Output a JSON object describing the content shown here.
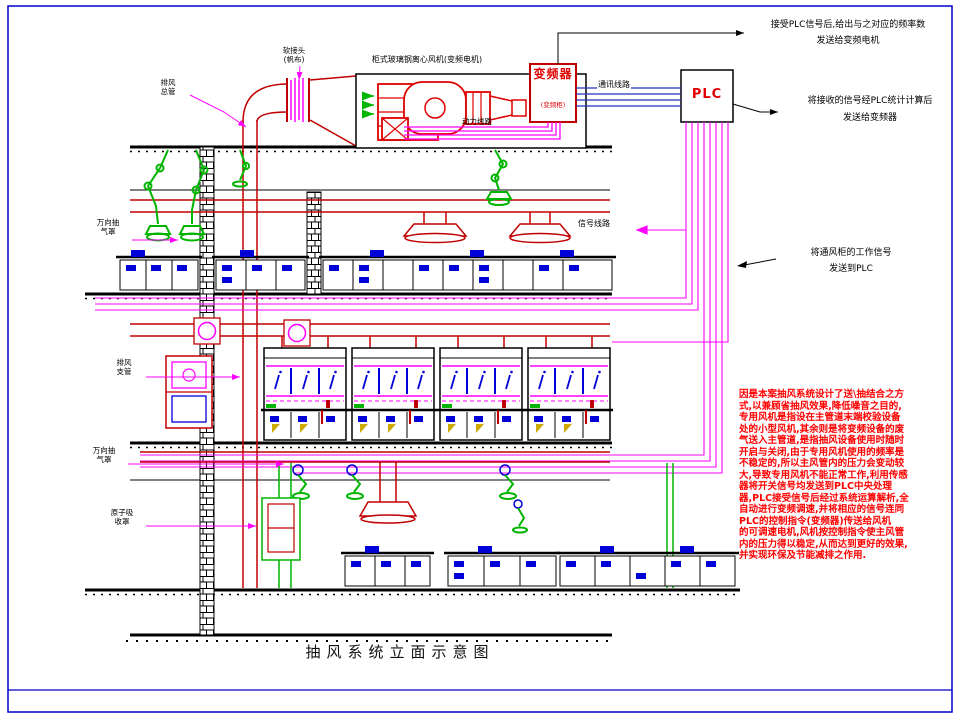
{
  "drawing": {
    "title": "抽风系统立面示意图",
    "colors": {
      "duct_red": "#c00000",
      "signal_magenta": "#ff00ff",
      "device_green": "#00b400",
      "bench_blue": "#0000d8",
      "comm_blue": "#2233bb",
      "note_red": "#ff0000",
      "border_blue": "#0000cc"
    },
    "equipment": {
      "fan_label": "柜式玻璃钢离心风机(变频电机)",
      "vfd_name": "变频器",
      "vfd_sub": "(变频柜)",
      "plc_name": "PLC"
    },
    "line_labels": {
      "comm": "通讯线路",
      "power": "动力线路",
      "signal": "信号线路"
    },
    "callouts": {
      "top_right": {
        "line1": "接受PLC信号后,给出与之对应的频率数",
        "line2": "发送给变频电机"
      },
      "plc_right": {
        "line1": "将接收的信号经PLC统计计算后",
        "line2": "发送给变频器"
      },
      "hood_signal": {
        "line1": "将通风柜的工作信号",
        "line2": "发送到PLC"
      },
      "left": [
        {
          "line1": "排风",
          "line2": "总管"
        },
        {
          "line1": "软接头",
          "line2": "(帆布)"
        },
        {
          "line1": "万向抽",
          "line2": "气罩"
        },
        {
          "line1": "排风",
          "line2": "支管"
        },
        {
          "line1": "万向抽",
          "line2": "气罩"
        },
        {
          "line1": "原子吸",
          "line2": "收罩"
        }
      ]
    },
    "description_lines": [
      "因是本案抽风系统设计了送\\抽结合之方",
      "式,以兼顾省抽风效果,降低噪音之目的,",
      "专用风机是指设在主管道末端校验设备",
      "处的小型风机,其余则是将变频设备的废",
      "气送入主管道,是指抽风设备使用时随时",
      "开启与关闭,由于专用风机使用的频率是",
      "不稳定的,所以主风管内的压力会变动较",
      "大,导致专用风机不能正常工作,利用传感",
      "器将开关信号均发送到PLC中央处理",
      "器,PLC接受信号后经过系统运算解析,全",
      "自动进行变频调速,并将相应的信号连同",
      "PLC的控制指令(变频器)传送给风机",
      "的可调速电机,风机按控制指令使主风管",
      "内的压力得以稳定,从而达到更好的效果,",
      "并实现环保及节能减排之作用."
    ]
  }
}
